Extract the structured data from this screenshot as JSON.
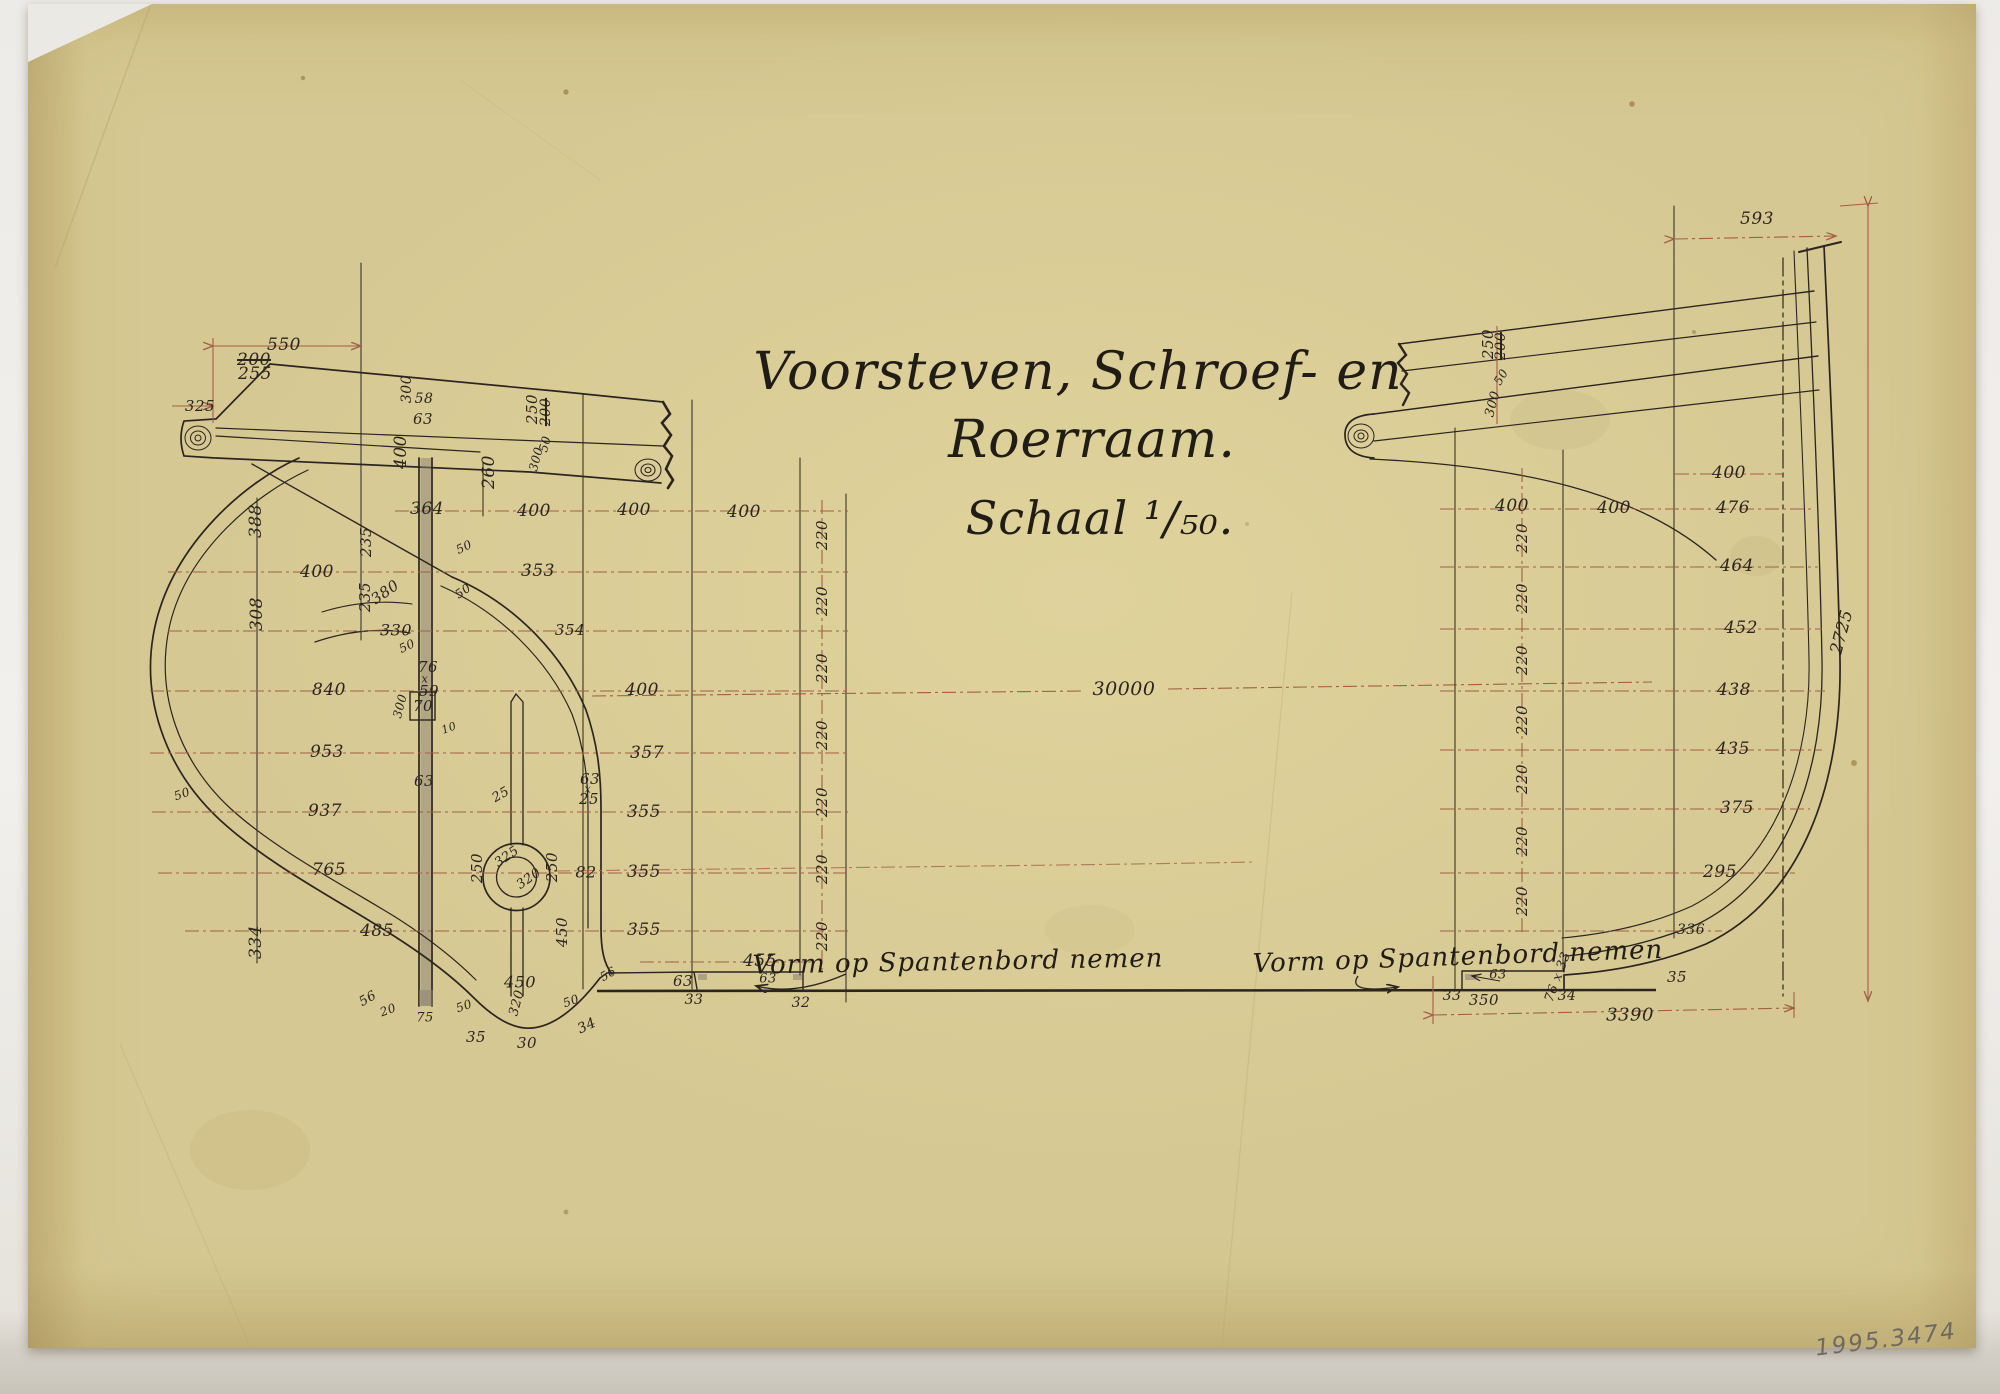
{
  "title": {
    "line1": "Voorsteven, Schroef- en",
    "line2": "Roerraam.",
    "line3": "Schaal ¹/₅₀."
  },
  "annotations": {
    "left_note": "Vorm op Spantenbord nemen",
    "right_note": "Vorm op Spantenbord nemen",
    "inventory_number": "1995.3474",
    "overall_length_dim": "30000"
  },
  "colors": {
    "paper": "#d6c892",
    "ink": "#2b2520",
    "dimension_red": "#a25f46",
    "pencil": "#6f6a5f"
  },
  "dim_labels": [
    {
      "t": "550",
      "x": 284,
      "y": 345
    },
    {
      "t": "200",
      "x": 254,
      "y": 360,
      "strike": true
    },
    {
      "t": "255",
      "x": 255,
      "y": 374
    },
    {
      "t": "325",
      "x": 200,
      "y": 406,
      "s": 15
    },
    {
      "t": "300",
      "x": 407,
      "y": 389,
      "r": -90,
      "s": 14
    },
    {
      "t": "58",
      "x": 424,
      "y": 399,
      "s": 14
    },
    {
      "t": "63",
      "x": 423,
      "y": 419,
      "s": 15
    },
    {
      "t": "400",
      "x": 401,
      "y": 452,
      "r": -90
    },
    {
      "t": "260",
      "x": 489,
      "y": 472,
      "r": -90
    },
    {
      "t": "250",
      "x": 532,
      "y": 409,
      "r": -90,
      "s": 15
    },
    {
      "t": "200",
      "x": 546,
      "y": 412,
      "r": -90,
      "s": 14,
      "strike": true
    },
    {
      "t": "300",
      "x": 536,
      "y": 459,
      "r": -75,
      "s": 12
    },
    {
      "t": "50",
      "x": 545,
      "y": 444,
      "r": -75,
      "s": 12
    },
    {
      "t": "364",
      "x": 427,
      "y": 509
    },
    {
      "t": "400",
      "x": 534,
      "y": 511
    },
    {
      "t": "400",
      "x": 634,
      "y": 510
    },
    {
      "t": "400",
      "x": 744,
      "y": 512
    },
    {
      "t": "388",
      "x": 256,
      "y": 521,
      "r": -90
    },
    {
      "t": "235",
      "x": 366,
      "y": 542,
      "r": -90,
      "s": 15
    },
    {
      "t": "50",
      "x": 464,
      "y": 547,
      "r": -25,
      "s": 12
    },
    {
      "t": "353",
      "x": 538,
      "y": 571
    },
    {
      "t": "400",
      "x": 317,
      "y": 572
    },
    {
      "t": "235",
      "x": 365,
      "y": 597,
      "r": -90,
      "s": 15
    },
    {
      "t": "380",
      "x": 385,
      "y": 592,
      "r": -35,
      "s": 15
    },
    {
      "t": "50",
      "x": 463,
      "y": 591,
      "r": -35,
      "s": 12
    },
    {
      "t": "308",
      "x": 257,
      "y": 614,
      "r": -90
    },
    {
      "t": "330",
      "x": 396,
      "y": 630,
      "s": 16
    },
    {
      "t": "354",
      "x": 570,
      "y": 630,
      "s": 15
    },
    {
      "t": "50",
      "x": 407,
      "y": 646,
      "r": -25,
      "s": 12
    },
    {
      "t": "76",
      "x": 428,
      "y": 667,
      "s": 15
    },
    {
      "t": "x",
      "x": 425,
      "y": 679,
      "s": 11
    },
    {
      "t": "59",
      "x": 429,
      "y": 691,
      "s": 15
    },
    {
      "t": "840",
      "x": 329,
      "y": 690
    },
    {
      "t": "400",
      "x": 642,
      "y": 690
    },
    {
      "t": "70",
      "x": 423,
      "y": 706,
      "s": 15
    },
    {
      "t": "300",
      "x": 400,
      "y": 706,
      "r": -75,
      "s": 12
    },
    {
      "t": "10",
      "x": 449,
      "y": 728,
      "r": -20,
      "s": 11
    },
    {
      "t": "953",
      "x": 327,
      "y": 752
    },
    {
      "t": "357",
      "x": 647,
      "y": 753
    },
    {
      "t": "63",
      "x": 424,
      "y": 781,
      "s": 15
    },
    {
      "t": "63",
      "x": 590,
      "y": 779,
      "s": 15
    },
    {
      "t": "x",
      "x": 588,
      "y": 789,
      "s": 11
    },
    {
      "t": "25",
      "x": 589,
      "y": 799,
      "s": 15
    },
    {
      "t": "25",
      "x": 501,
      "y": 795,
      "r": -30,
      "s": 13
    },
    {
      "t": "50",
      "x": 182,
      "y": 794,
      "r": -20,
      "s": 12
    },
    {
      "t": "937",
      "x": 325,
      "y": 811
    },
    {
      "t": "355",
      "x": 644,
      "y": 812
    },
    {
      "t": "325",
      "x": 507,
      "y": 857,
      "r": -35,
      "s": 13
    },
    {
      "t": "320",
      "x": 529,
      "y": 879,
      "r": -35,
      "s": 13
    },
    {
      "t": "250",
      "x": 477,
      "y": 868,
      "r": -90,
      "s": 15
    },
    {
      "t": "250",
      "x": 552,
      "y": 867,
      "r": -90,
      "s": 15
    },
    {
      "t": "82",
      "x": 586,
      "y": 872,
      "s": 16
    },
    {
      "t": "355",
      "x": 644,
      "y": 872
    },
    {
      "t": "765",
      "x": 329,
      "y": 870
    },
    {
      "t": "334",
      "x": 256,
      "y": 942,
      "r": -90
    },
    {
      "t": "485",
      "x": 377,
      "y": 931
    },
    {
      "t": "355",
      "x": 644,
      "y": 930
    },
    {
      "t": "450",
      "x": 562,
      "y": 932,
      "r": -90,
      "s": 15
    },
    {
      "t": "56",
      "x": 368,
      "y": 999,
      "r": -30,
      "s": 13
    },
    {
      "t": "20",
      "x": 388,
      "y": 1010,
      "r": -20,
      "s": 12
    },
    {
      "t": "75",
      "x": 425,
      "y": 1018,
      "s": 13
    },
    {
      "t": "50",
      "x": 464,
      "y": 1006,
      "r": -20,
      "s": 12
    },
    {
      "t": "450",
      "x": 520,
      "y": 982,
      "s": 16
    },
    {
      "t": "320",
      "x": 517,
      "y": 1003,
      "r": -75,
      "s": 13
    },
    {
      "t": "50",
      "x": 571,
      "y": 1001,
      "r": -20,
      "s": 12
    },
    {
      "t": "35",
      "x": 476,
      "y": 1037,
      "s": 15
    },
    {
      "t": "30",
      "x": 527,
      "y": 1043,
      "s": 15
    },
    {
      "t": "34",
      "x": 587,
      "y": 1026,
      "r": -25,
      "s": 14
    },
    {
      "t": "56",
      "x": 608,
      "y": 974,
      "r": -30,
      "s": 12
    },
    {
      "t": "63",
      "x": 683,
      "y": 981,
      "s": 15
    },
    {
      "t": "33",
      "x": 694,
      "y": 1000,
      "s": 14
    },
    {
      "t": "455",
      "x": 760,
      "y": 961
    },
    {
      "t": "63",
      "x": 768,
      "y": 979,
      "s": 13
    },
    {
      "t": "32",
      "x": 801,
      "y": 1003,
      "s": 14
    },
    {
      "t": "220",
      "x": 822,
      "y": 535,
      "r": -90,
      "s": 15
    },
    {
      "t": "220",
      "x": 822,
      "y": 601,
      "r": -90,
      "s": 15
    },
    {
      "t": "220",
      "x": 822,
      "y": 668,
      "r": -90,
      "s": 15
    },
    {
      "t": "220",
      "x": 822,
      "y": 735,
      "r": -90,
      "s": 15
    },
    {
      "t": "220",
      "x": 822,
      "y": 802,
      "r": -90,
      "s": 15
    },
    {
      "t": "220",
      "x": 822,
      "y": 869,
      "r": -90,
      "s": 15
    },
    {
      "t": "220",
      "x": 822,
      "y": 936,
      "r": -90,
      "s": 15
    },
    {
      "t": "30000",
      "x": 1124,
      "y": 689,
      "s": 19
    },
    {
      "t": "593",
      "x": 1757,
      "y": 219
    },
    {
      "t": "250",
      "x": 1488,
      "y": 344,
      "r": -90,
      "s": 15
    },
    {
      "t": "200",
      "x": 1501,
      "y": 346,
      "r": -90,
      "s": 14,
      "strike": true
    },
    {
      "t": "50",
      "x": 1501,
      "y": 377,
      "r": -60,
      "s": 12
    },
    {
      "t": "300",
      "x": 1493,
      "y": 404,
      "r": -75,
      "s": 13
    },
    {
      "t": "400",
      "x": 1729,
      "y": 473
    },
    {
      "t": "400",
      "x": 1512,
      "y": 506
    },
    {
      "t": "400",
      "x": 1614,
      "y": 508
    },
    {
      "t": "476",
      "x": 1733,
      "y": 508
    },
    {
      "t": "464",
      "x": 1737,
      "y": 566
    },
    {
      "t": "452",
      "x": 1741,
      "y": 628
    },
    {
      "t": "438",
      "x": 1734,
      "y": 690
    },
    {
      "t": "435",
      "x": 1733,
      "y": 749
    },
    {
      "t": "375",
      "x": 1737,
      "y": 808
    },
    {
      "t": "295",
      "x": 1720,
      "y": 872
    },
    {
      "t": "336",
      "x": 1691,
      "y": 930,
      "s": 14
    },
    {
      "t": "35",
      "x": 1677,
      "y": 977,
      "s": 15
    },
    {
      "t": "2725",
      "x": 1842,
      "y": 632,
      "r": -75
    },
    {
      "t": "220",
      "x": 1522,
      "y": 538,
      "r": -90,
      "s": 15
    },
    {
      "t": "220",
      "x": 1522,
      "y": 598,
      "r": -90,
      "s": 15
    },
    {
      "t": "220",
      "x": 1522,
      "y": 660,
      "r": -90,
      "s": 15
    },
    {
      "t": "220",
      "x": 1522,
      "y": 720,
      "r": -90,
      "s": 15
    },
    {
      "t": "220",
      "x": 1522,
      "y": 779,
      "r": -90,
      "s": 15
    },
    {
      "t": "220",
      "x": 1522,
      "y": 841,
      "r": -90,
      "s": 15
    },
    {
      "t": "220",
      "x": 1522,
      "y": 901,
      "r": -90,
      "s": 15
    },
    {
      "t": "63",
      "x": 1498,
      "y": 975,
      "s": 13
    },
    {
      "t": "76 x 33",
      "x": 1558,
      "y": 977,
      "r": -70,
      "s": 13
    },
    {
      "t": "33",
      "x": 1452,
      "y": 996,
      "s": 14
    },
    {
      "t": "350",
      "x": 1484,
      "y": 1000,
      "s": 15
    },
    {
      "t": "34",
      "x": 1567,
      "y": 996,
      "s": 14
    },
    {
      "t": "3390",
      "x": 1630,
      "y": 1015,
      "s": 18
    }
  ]
}
